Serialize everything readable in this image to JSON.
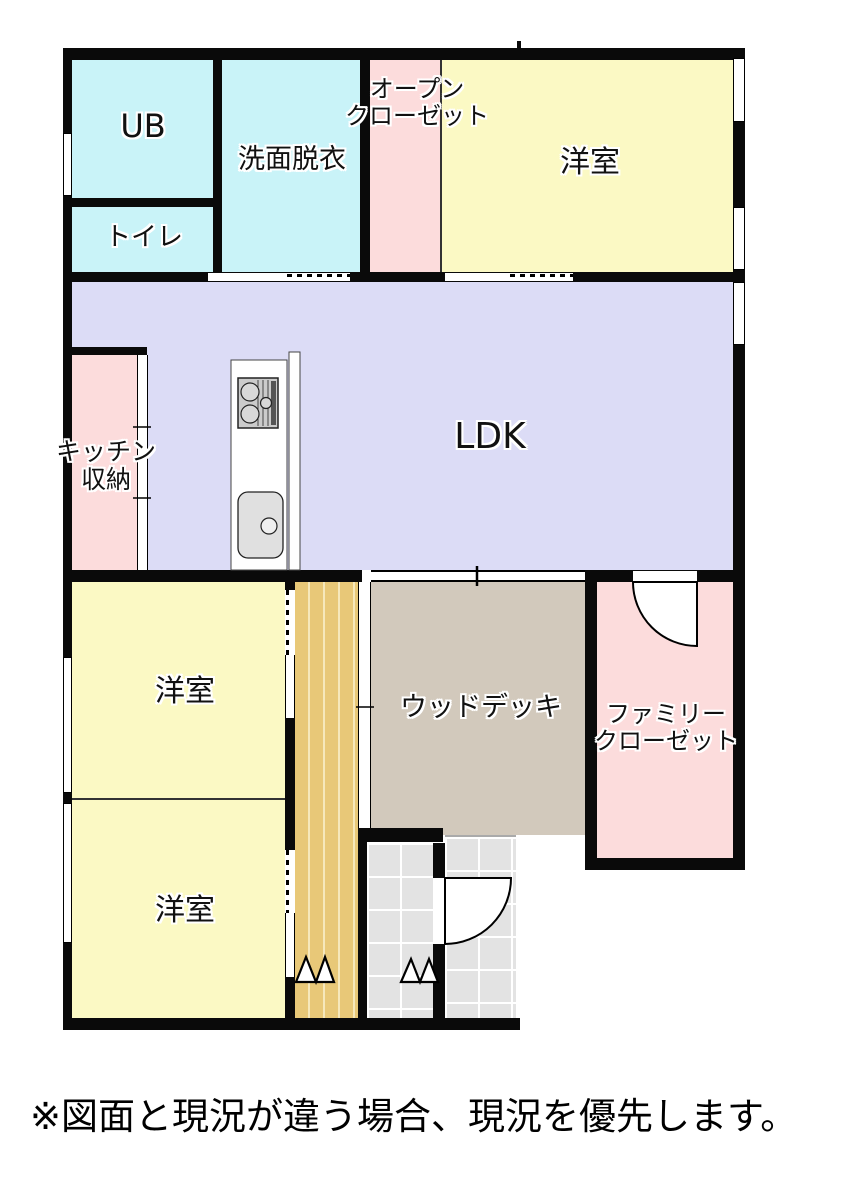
{
  "colors": {
    "wall": "#0a0a0a",
    "wet": "#c9f3f8",
    "pink": "#fcdcdc",
    "yellow": "#fbf9c4",
    "ldk": "#dcdcf6",
    "hall": "#e8c878",
    "deck": "#d2c9bc",
    "tile": "#e3e3e3"
  },
  "rooms": {
    "ub": {
      "label": "UB"
    },
    "toilet": {
      "label": "トイレ"
    },
    "washroom": {
      "label": "洗面脱衣"
    },
    "open_closet": {
      "line1": "オープン",
      "line2": "クローゼット"
    },
    "bedroom_top": {
      "label": "洋室"
    },
    "ldk": {
      "label": "LDK"
    },
    "kitchen_storage": {
      "line1": "キッチン",
      "line2": "収納"
    },
    "bedroom_mid": {
      "label": "洋室"
    },
    "bedroom_bottom": {
      "label": "洋室"
    },
    "wood_deck": {
      "label": "ウッドデッキ"
    },
    "family_closet": {
      "line1": "ファミリー",
      "line2": "クローゼット"
    }
  },
  "footnote": "※図面と現況が違う場合、現況を優先します。"
}
